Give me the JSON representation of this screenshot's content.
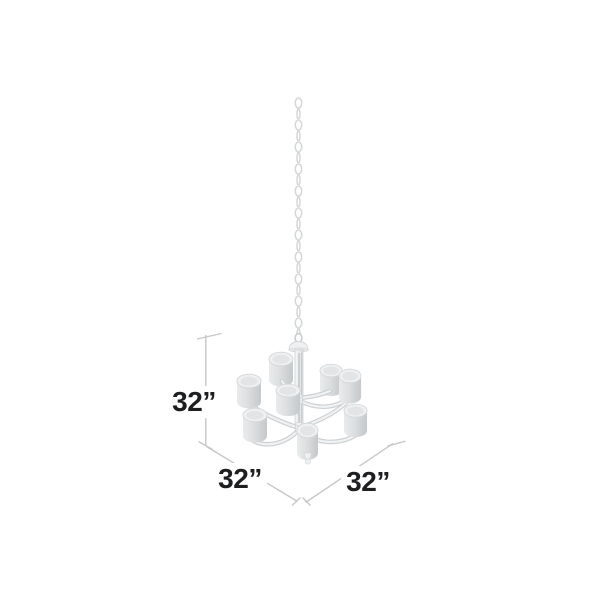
{
  "diagram": {
    "type": "product-dimensions-diagram",
    "illustration": "nine-light-two-tier-drum-shade-chandelier-hanging-from-chain",
    "labels": {
      "height": "32”",
      "depth": "32”",
      "width": "32”"
    },
    "colors": {
      "background": "#ffffff",
      "dimension_line": "#c5c8ca",
      "label_text": "#1d1e20",
      "fixture_stroke": "#cfd2d4",
      "fixture_fill_light": "#f0f1f2",
      "fixture_fill_mid": "#dcdee0",
      "fixture_fill_dark": "#c6c9cb",
      "chain": "#d4d7d9"
    }
  }
}
